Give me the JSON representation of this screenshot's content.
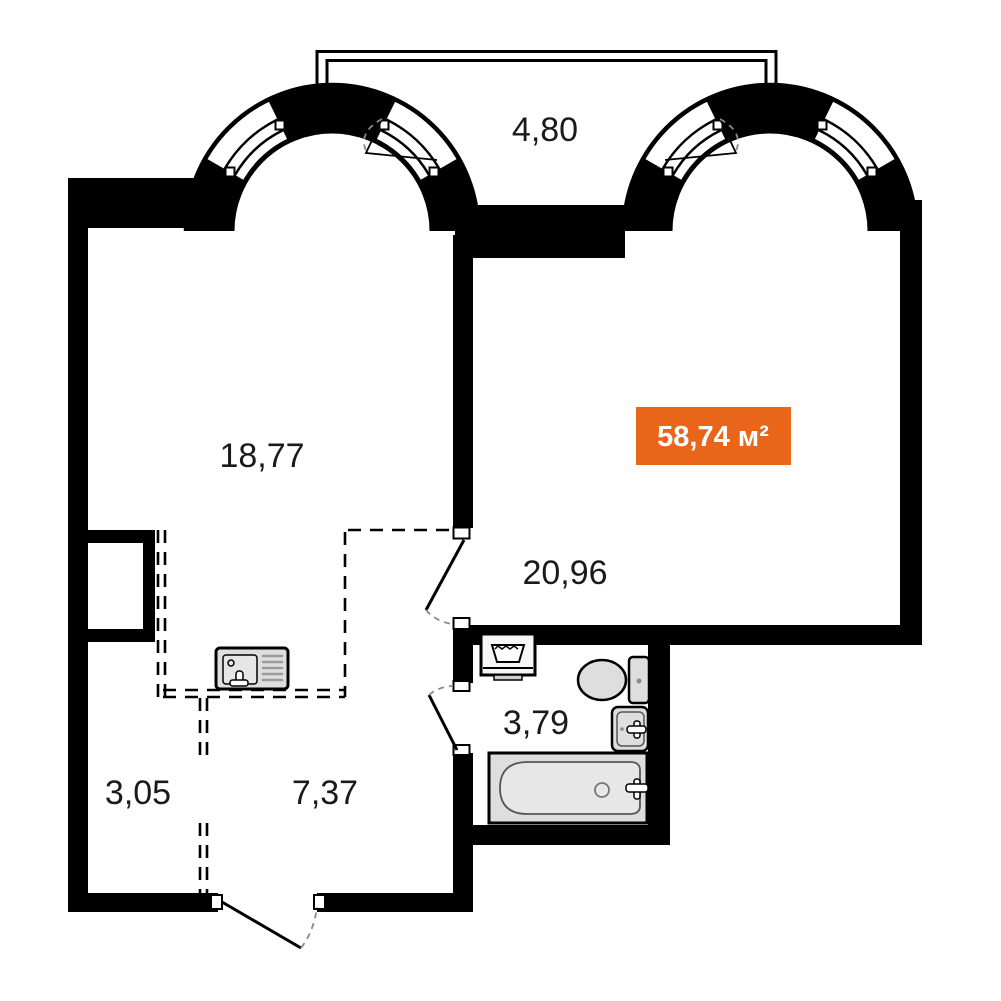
{
  "plan": {
    "type": "apartment-floor-plan",
    "total_area_label": "58,74 м²",
    "rooms": {
      "balcony": {
        "area": "4,80"
      },
      "living_left": {
        "area": "18,77"
      },
      "living_right": {
        "area": "20,96"
      },
      "bathroom": {
        "area": "3,79"
      },
      "hall_left": {
        "area": "3,05"
      },
      "hall_right": {
        "area": "7,37"
      }
    },
    "fixtures": {
      "kitchen_sink": "kitchen-sink-icon",
      "washing_machine": "washing-machine-icon",
      "toilet": "toilet-icon",
      "washbasin": "washbasin-icon",
      "bathtub": "bathtub-icon"
    },
    "colors": {
      "wall": "#000000",
      "accent": "#E8651A",
      "fixture_fill": "#DEDEDE",
      "label": "#1A1A1A",
      "badge_text": "#FFFFFF"
    }
  }
}
